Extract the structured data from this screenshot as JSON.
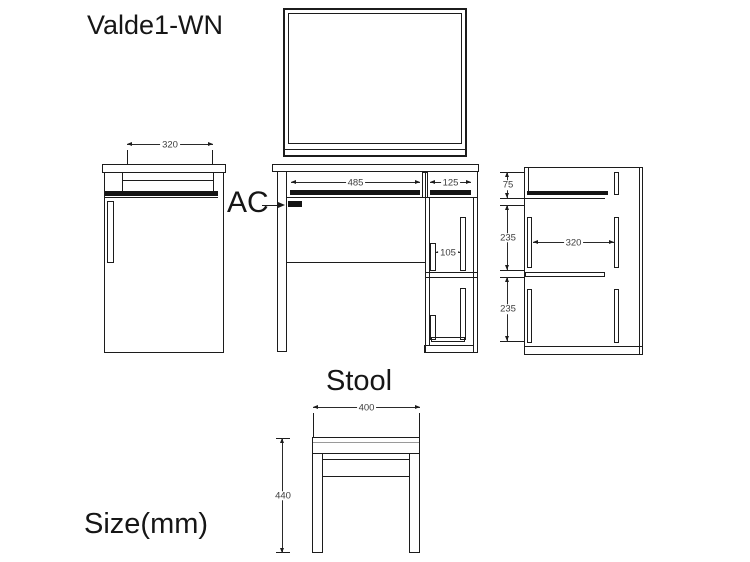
{
  "labels": {
    "model": "Valde1-WN",
    "ac": "AC",
    "stool": "Stool",
    "size_unit": "Size(mm)"
  },
  "dimensions": {
    "side_left": {
      "top_depth": "320"
    },
    "front": {
      "open_width": "485",
      "cabinet_width": "125",
      "handle_gap": "105"
    },
    "side_right": {
      "top_section": "75",
      "middle_section": "235",
      "bottom_section": "235",
      "inner_depth": "320"
    },
    "stool": {
      "seat_width": "400",
      "height": "440"
    }
  },
  "colors": {
    "line": "#1c1c1c",
    "dim_text": "#3d3d3d",
    "background": "#ffffff"
  }
}
